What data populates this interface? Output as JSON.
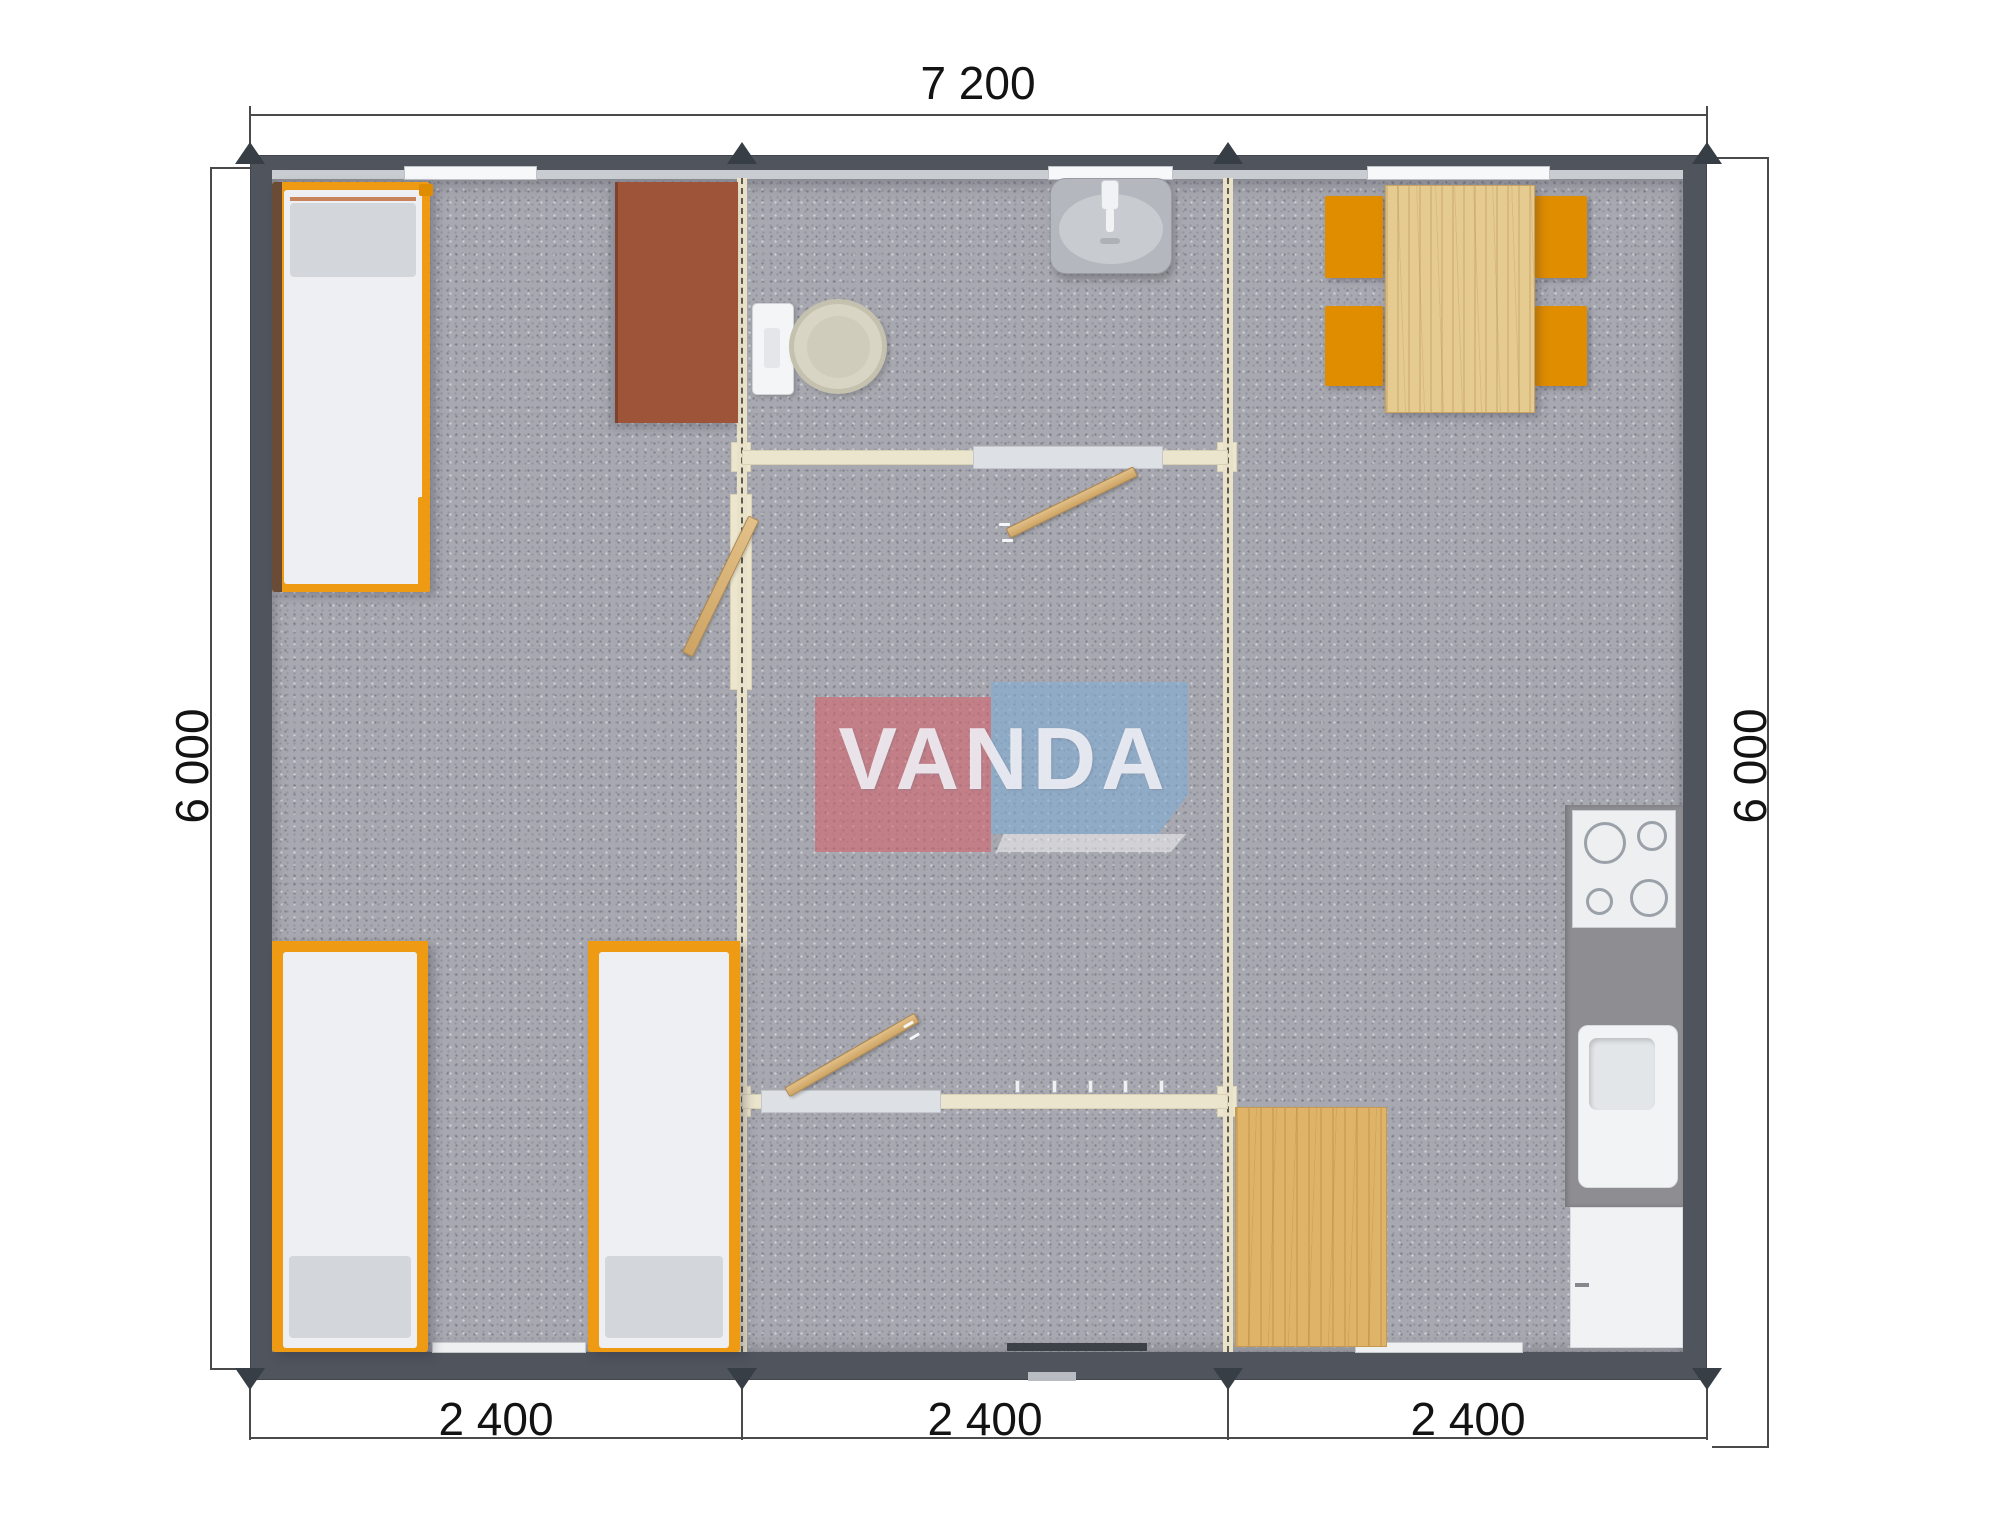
{
  "document": {
    "type": "modular-house-floor-plan-render",
    "background": "#ffffff"
  },
  "logo": {
    "text": "VANDA",
    "red_box_color": "#d5626b",
    "blue_box_color": "#80aed5",
    "text_color": "#f6f6fa"
  },
  "dimensions": {
    "top": {
      "label": "7 200"
    },
    "left": {
      "label": "6 000"
    },
    "right": {
      "label": "6 000"
    },
    "bottom_segments": [
      {
        "label": "2 400"
      },
      {
        "label": "2 400"
      },
      {
        "label": "2 400"
      }
    ]
  },
  "palette": {
    "exterior_wall": "#4f545d",
    "floor_carpet": "#a8a8b0",
    "module_joint": "#e9e2c8",
    "interior_wall": "#ebe5cd",
    "bed_frame_orange": "#ee9a12",
    "mattress_white": "#edeff3",
    "pillow_gray": "#d3d7db",
    "wardrobe_brown": "#9d5438",
    "chair_orange": "#e18d00",
    "table_wood": "#e6cb90",
    "mat_wood": "#dfb469",
    "kitchen_counter": "#8d8d92",
    "fixture_white": "#f1f3f5",
    "door_wood": "#d9b67e",
    "dimension_text": "#131313"
  },
  "furniture": {
    "module_left": [
      "single-bed",
      "single-bed",
      "single-bed",
      "wardrobe"
    ],
    "module_middle": [
      "washbasin",
      "toilet",
      "sliding-door",
      "hinged-door",
      "hinged-door",
      "hinged-door",
      "entrance-step"
    ],
    "module_right": [
      "dining-table",
      "dining-chair",
      "dining-chair",
      "dining-chair",
      "dining-chair",
      "cooktop",
      "kitchen-sink",
      "kitchen-cabinet",
      "wooden-floor-mat"
    ]
  }
}
